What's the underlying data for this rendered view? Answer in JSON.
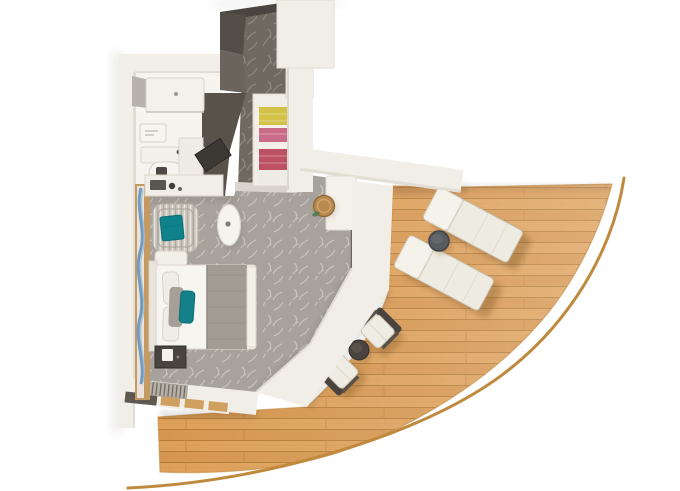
{
  "scene": {
    "type": "stateroom-floor-plan",
    "rooms": [
      {
        "id": "bathroom",
        "label": "bathroom"
      },
      {
        "id": "entry-hallway",
        "label": "entry hallway"
      },
      {
        "id": "wardrobe-closet",
        "label": "open closet with towels"
      },
      {
        "id": "bedroom",
        "label": "bedroom and sitting area"
      },
      {
        "id": "balcony",
        "label": "curved private balcony with wood deck"
      }
    ],
    "furniture": {
      "bathroom": [
        "shower",
        "shower-screen",
        "vanity-counter",
        "sink-faucet",
        "toilet",
        "wall-unit"
      ],
      "bedroom": [
        "double-bed",
        "gray-duvet",
        "teal-accent-pillow",
        "striped-armchair",
        "teal-throw",
        "ottoman",
        "desk-vanity",
        "wall-tv",
        "oval-side-table",
        "round-stool",
        "foot-cabinet",
        "window-curtain"
      ],
      "closet": [
        "yellow-towels",
        "pink-towels",
        "red-towels"
      ],
      "balcony": [
        "sun-lounger-1",
        "sun-lounger-2",
        "lounger-side-table",
        "deck-chair-1",
        "deck-chair-2",
        "round-coffee-table",
        "curved-railing"
      ]
    }
  },
  "palette": {
    "wall": "#f1eee8",
    "wall_edge": "#dfdad0",
    "bathroom_floor": "#f6f4ef",
    "carpet": "#a7a29b",
    "carpet_texture": "#cdc9c2",
    "corridor_carpet": "#6f6962",
    "corridor_texture": "#958e86",
    "sill": "#d9d5ce",
    "wood": "#dda05a",
    "wood_dark": "#d59650",
    "wood_line": "#b57c39",
    "railing": "#c08a3e",
    "door_dark": "#4a4540",
    "dark_wall_upper": "#544e48",
    "dark_wall_lower": "#6b645c",
    "wardrobe": "#59524b",
    "towel_yellow": "#d3c247",
    "towel_pink": "#cb6b8a",
    "towel_red": "#bc5064",
    "curtain_wood": "#c59a62",
    "curtain_blue": "#6f9cc0",
    "teal_throw": "#10828b",
    "teal_pillow": "#158089",
    "duvet": "#a29c94",
    "tv": "#3c3834",
    "stool": "#b9894f",
    "lounger_pad": "#eeebe2",
    "lounger_back": "#f4f2ea",
    "side_table": "#565b5e",
    "coffee_table": "#48433e",
    "chair_frame": "#4a443e",
    "cushion": "#efece4",
    "dark_window": "#5f5952",
    "window_tan": "#cfa05f"
  }
}
